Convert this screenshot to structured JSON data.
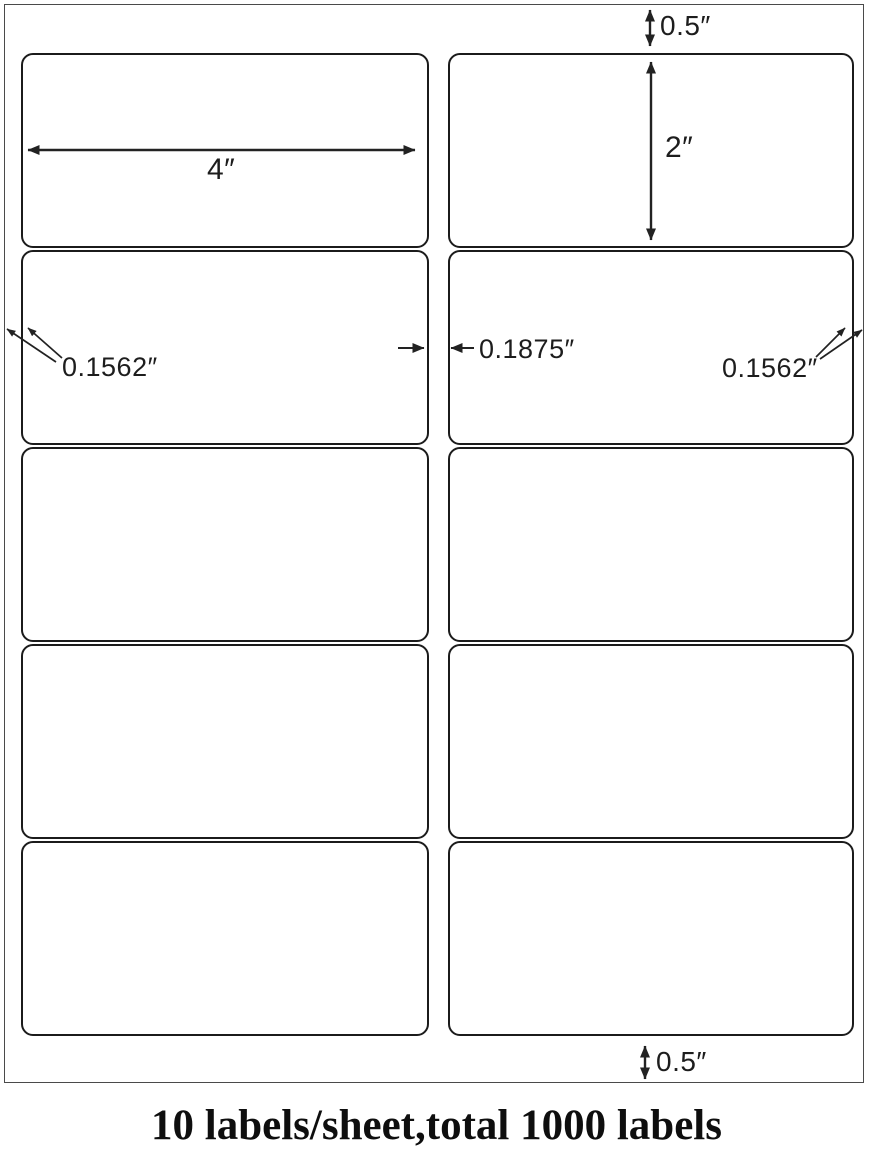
{
  "diagram": {
    "title": "label-sheet dimension diagram",
    "grid": {
      "columns": 2,
      "rows": 5,
      "label_count": 10
    },
    "annotations": {
      "top_margin": "0.5″",
      "label_height": "2″",
      "label_width": "4″",
      "left_margin": "0.1562″",
      "column_gap": "0.1875″",
      "right_margin": "0.1562″",
      "bottom_margin": "0.5″"
    },
    "caption": "10 labels/sheet,total 1000 labels",
    "colors": {
      "background": "#ffffff",
      "line": "#222222",
      "label_border": "#1b1b1b",
      "sheet_border": "#4a4a4a",
      "caption_text": "#0e0e0e"
    }
  }
}
